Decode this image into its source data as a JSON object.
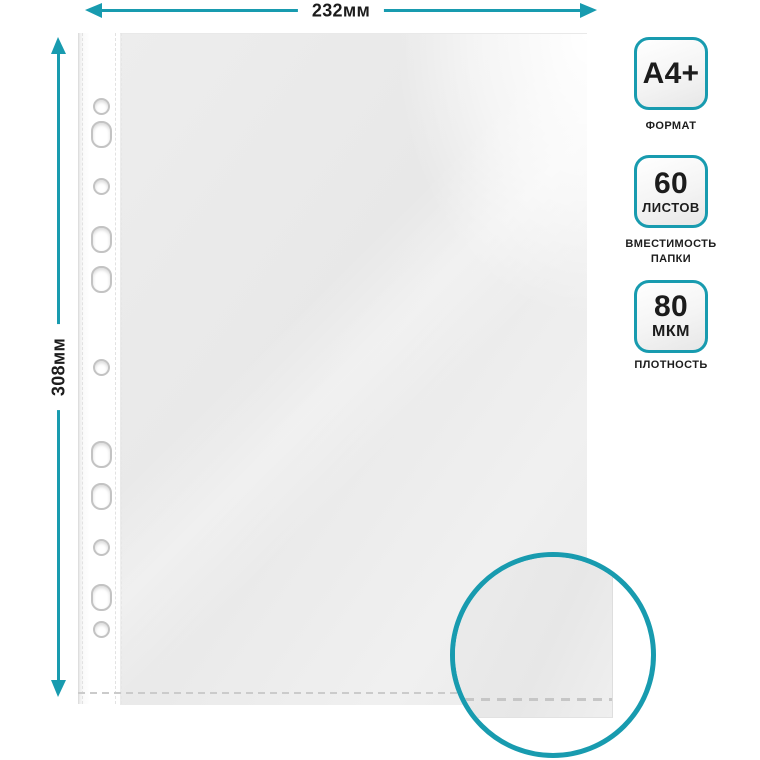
{
  "dimension_annotations": {
    "width_label": "232мм",
    "height_label": "308мм"
  },
  "spec_badges": {
    "format": {
      "value": "A4+",
      "caption": "ФОРМАТ"
    },
    "capacity": {
      "value": "60",
      "unit": "ЛИСТОВ",
      "caption_line1": "ВМЕСТИМОСТЬ",
      "caption_line2": "ПАПКИ"
    },
    "thickness": {
      "value": "80",
      "unit": "МКМ",
      "caption": "ПЛОТНОСТЬ"
    }
  },
  "product_visual": {
    "punch_holes_count": 11,
    "hole_shapes": [
      "round",
      "oval",
      "round",
      "oval",
      "oval",
      "round",
      "oval",
      "oval",
      "round",
      "oval",
      "round"
    ]
  },
  "colors": {
    "accent_teal": "#189BAF",
    "text_black": "#1C1C1C",
    "sheet_body_gray": "#EBEBEB"
  }
}
